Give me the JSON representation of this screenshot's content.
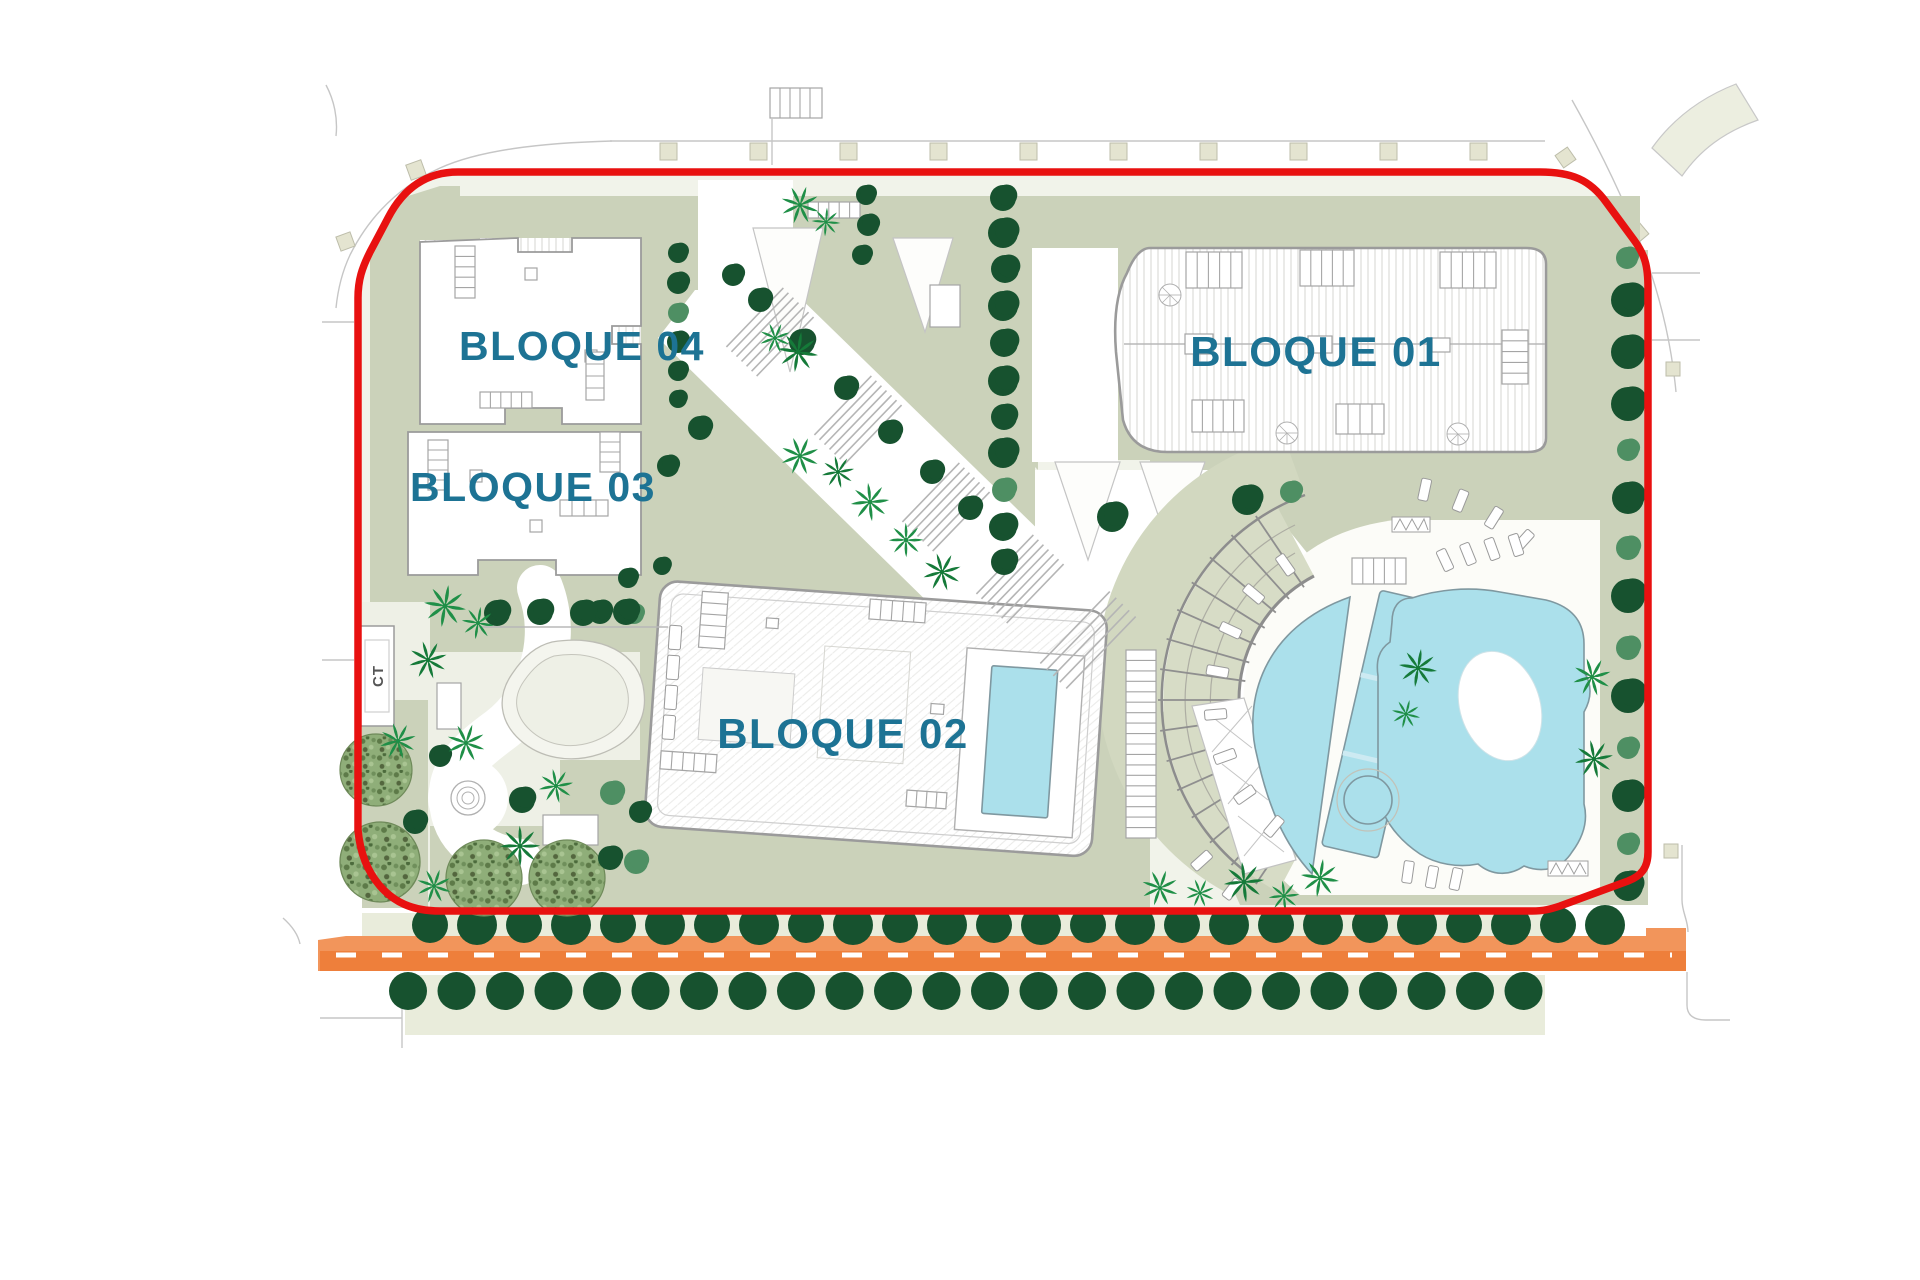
{
  "plan": {
    "labels": {
      "block01": "BLOQUE 01",
      "block02": "BLOQUE 02",
      "block03": "BLOQUE 03",
      "block04": "BLOQUE 04",
      "transformer": "CT"
    },
    "colors": {
      "boundary_red": "#e81110",
      "road_orange": "#f2955b",
      "road_orange_dark": "#ee7f3b",
      "pool_cyan": "#abe0eb",
      "label_teal": "#1d7394",
      "landscape_sage": "#cbd2ba",
      "tree_dark": "#17522f",
      "tree_medium": "#4e8f63",
      "palm_green": "#1f8f47"
    }
  }
}
